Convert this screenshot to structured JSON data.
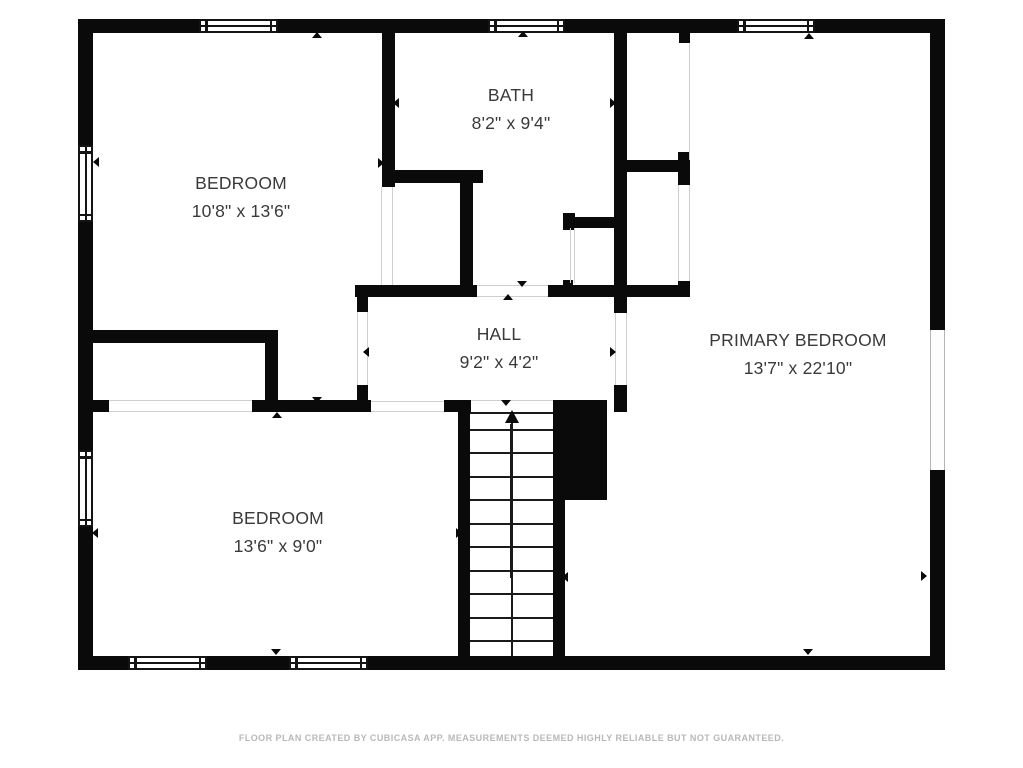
{
  "footer": {
    "text": "FLOOR PLAN CREATED BY CUBICASA APP. MEASUREMENTS DEEMED HIGHLY RELIABLE BUT NOT GUARANTEED."
  },
  "rooms": [
    {
      "id": "bedroom-top-left",
      "name": "BEDROOM",
      "dims": "10'8\" x 13'6\"",
      "cx": 241,
      "top": 169
    },
    {
      "id": "bath",
      "name": "BATH",
      "dims": "8'2\" x 9'4\"",
      "cx": 511,
      "top": 81
    },
    {
      "id": "primary-bedroom",
      "name": "PRIMARY BEDROOM",
      "dims": "13'7\" x 22'10\"",
      "cx": 798,
      "top": 326
    },
    {
      "id": "hall",
      "name": "HALL",
      "dims": "9'2\" x 4'2\"",
      "cx": 499,
      "top": 320
    },
    {
      "id": "bedroom-bottom-left",
      "name": "BEDROOM",
      "dims": "13'6\" x 9'0\"",
      "cx": 278,
      "top": 504
    }
  ],
  "colors": {
    "wall": "#0a0a0a",
    "room_text": "#3a3a3a",
    "footer_text": "#b8b8b8",
    "opening_line": "#cfcfcf",
    "background": "#ffffff"
  },
  "geometry": {
    "walls": [
      [
        78,
        19,
        867,
        14
      ],
      [
        78,
        19,
        15,
        651
      ],
      [
        930,
        19,
        15,
        651
      ],
      [
        78,
        656,
        867,
        14
      ],
      [
        382,
        33,
        13,
        154
      ],
      [
        382,
        170,
        101,
        13
      ],
      [
        460,
        170,
        13,
        127
      ],
      [
        355,
        285,
        122,
        12
      ],
      [
        357,
        285,
        11,
        27
      ],
      [
        357,
        385,
        11,
        20
      ],
      [
        548,
        285,
        142,
        12
      ],
      [
        614,
        33,
        13,
        280
      ],
      [
        614,
        385,
        13,
        27
      ],
      [
        627,
        160,
        63,
        12
      ],
      [
        678,
        152,
        12,
        33
      ],
      [
        678,
        281,
        12,
        16
      ],
      [
        563,
        217,
        52,
        11
      ],
      [
        563,
        213,
        12,
        17
      ],
      [
        563,
        280,
        10,
        6
      ],
      [
        93,
        330,
        185,
        13
      ],
      [
        265,
        330,
        13,
        82
      ],
      [
        78,
        400,
        31,
        12
      ],
      [
        252,
        400,
        119,
        12
      ],
      [
        444,
        400,
        27,
        12
      ],
      [
        458,
        400,
        12,
        256
      ],
      [
        553,
        500,
        12,
        156
      ],
      [
        553,
        400,
        54,
        100
      ],
      [
        679,
        33,
        11,
        10
      ]
    ],
    "windows_framed": [
      {
        "x": 199,
        "y": 19,
        "w": 79,
        "h": 14,
        "o": "h"
      },
      {
        "x": 488,
        "y": 19,
        "w": 77,
        "h": 14,
        "o": "h"
      },
      {
        "x": 737,
        "y": 19,
        "w": 78,
        "h": 14,
        "o": "h"
      },
      {
        "x": 78,
        "y": 145,
        "w": 15,
        "h": 77,
        "o": "v"
      },
      {
        "x": 78,
        "y": 450,
        "w": 15,
        "h": 77,
        "o": "v"
      },
      {
        "x": 128,
        "y": 656,
        "w": 79,
        "h": 14,
        "o": "h"
      },
      {
        "x": 289,
        "y": 656,
        "w": 79,
        "h": 14,
        "o": "h"
      }
    ],
    "windows_plain": [
      {
        "x": 930,
        "y": 330,
        "w": 15,
        "h": 140
      }
    ],
    "opening_lines": [
      [
        381,
        187,
        1,
        98
      ],
      [
        392,
        187,
        1,
        98
      ],
      [
        357,
        312,
        1,
        73
      ],
      [
        367,
        312,
        1,
        73
      ],
      [
        615,
        313,
        1,
        72
      ],
      [
        626,
        313,
        1,
        72
      ],
      [
        477,
        285,
        71,
        1
      ],
      [
        477,
        296,
        71,
        1
      ],
      [
        109,
        400,
        143,
        1
      ],
      [
        109,
        411,
        143,
        1
      ],
      [
        371,
        401,
        73,
        1
      ],
      [
        371,
        411,
        73,
        1
      ],
      [
        471,
        400,
        82,
        1
      ],
      [
        678,
        185,
        1,
        96
      ],
      [
        689,
        185,
        1,
        96
      ],
      [
        570,
        228,
        1,
        55
      ],
      [
        574,
        228,
        1,
        55
      ],
      [
        689,
        43,
        1,
        117
      ]
    ],
    "markers": [
      {
        "x": 312,
        "y": 32,
        "dir": "up"
      },
      {
        "x": 518,
        "y": 31,
        "dir": "up"
      },
      {
        "x": 804,
        "y": 33,
        "dir": "up"
      },
      {
        "x": 93,
        "y": 157,
        "dir": "left"
      },
      {
        "x": 393,
        "y": 98,
        "dir": "left"
      },
      {
        "x": 610,
        "y": 98,
        "dir": "right"
      },
      {
        "x": 378,
        "y": 158,
        "dir": "right"
      },
      {
        "x": 363,
        "y": 347,
        "dir": "left"
      },
      {
        "x": 610,
        "y": 347,
        "dir": "right"
      },
      {
        "x": 517,
        "y": 281,
        "dir": "down"
      },
      {
        "x": 503,
        "y": 294,
        "dir": "up"
      },
      {
        "x": 312,
        "y": 397,
        "dir": "down"
      },
      {
        "x": 272,
        "y": 412,
        "dir": "up"
      },
      {
        "x": 501,
        "y": 400,
        "dir": "down"
      },
      {
        "x": 456,
        "y": 528,
        "dir": "right"
      },
      {
        "x": 562,
        "y": 572,
        "dir": "left"
      },
      {
        "x": 92,
        "y": 528,
        "dir": "left"
      },
      {
        "x": 921,
        "y": 571,
        "dir": "right"
      },
      {
        "x": 271,
        "y": 649,
        "dir": "down"
      },
      {
        "x": 803,
        "y": 649,
        "dir": "down"
      }
    ],
    "stairs": {
      "x": 470,
      "y": 412,
      "w": 83,
      "h": 244,
      "tread_ys": [
        412,
        429,
        452,
        476,
        499,
        523,
        546,
        570,
        593,
        617,
        640
      ],
      "center_x": 511,
      "arrow": {
        "shaft_x": 510,
        "shaft_y1": 424,
        "shaft_y2": 578,
        "head_x": 505,
        "head_y": 410,
        "head_w": 7,
        "head_h": 13
      }
    }
  }
}
